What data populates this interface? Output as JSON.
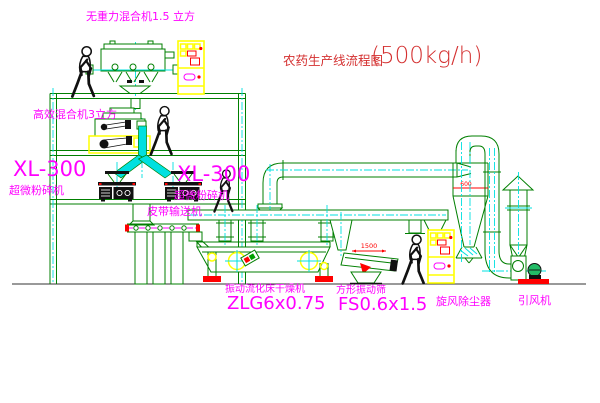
{
  "title": {
    "name": "农药生产线流程图",
    "capacity": "(500kg/h)"
  },
  "equipment_labels": {
    "gravity_mixer": "无重力混合机1.5 立方",
    "high_efficiency_mixer": "高效混合机3立方",
    "mill_left_model": "XL-300",
    "mill_left_name": "超微粉碎机",
    "mill_right_model": "XL-300",
    "mill_right_name": "超微粉碎机",
    "belt_conveyor": "皮带输送机",
    "dryer_name": "振动流化床干燥机",
    "dryer_model": "ZLG6x0.75",
    "sieve_name": "方形振动筛",
    "sieve_model": "FS0.6x1.5",
    "cyclone": "旋风除尘器",
    "fan": "引风机"
  },
  "dimensions": {
    "sieve_length": "1500",
    "cyclone_diameter": "600"
  },
  "colors": {
    "line_green": "#007f00",
    "centerline_cyan": "#00e0e0",
    "label_magenta": "#ff00ff",
    "title_red": "#d43030",
    "dim_red": "#ff0000",
    "highlight_yellow": "#ffff00",
    "background": "#ffffff"
  }
}
